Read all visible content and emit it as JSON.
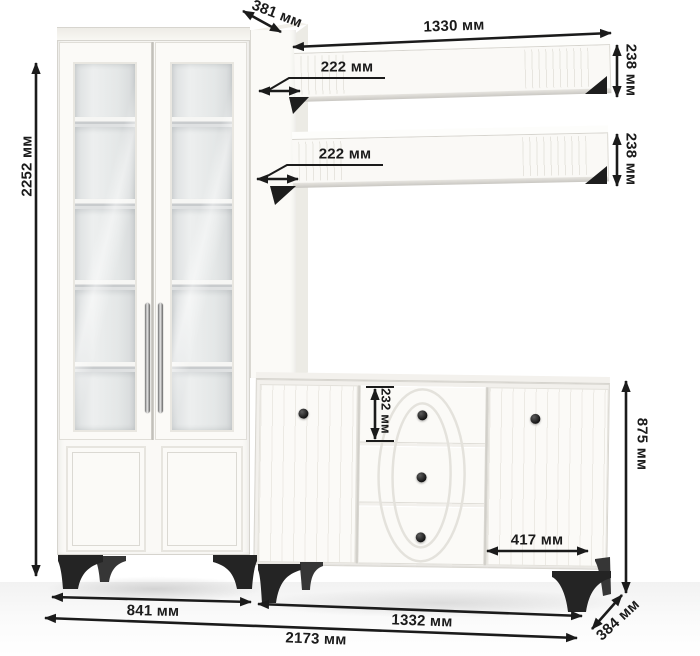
{
  "title": "furniture-dimensions-diagram",
  "units": "мм",
  "labels": {
    "total_height": "2252 мм",
    "column_depth": "381 мм",
    "shelf_width": "1330 мм",
    "shelf_depth_upper": "222 мм",
    "shelf_depth_lower": "222 мм",
    "shelf_height_upper": "238 мм",
    "shelf_height_lower": "238 мм",
    "drawer_height": "232 мм",
    "door_width": "417 мм",
    "sideboard_height": "875 мм",
    "cabinet_width": "841 мм",
    "sideboard_width": "1332 мм",
    "total_width": "2173 мм",
    "sideboard_depth": "384 мм"
  },
  "colors": {
    "background": "#ffffff",
    "furniture_white": "#faf9f6",
    "glass_interior": "#e6e8e9",
    "legs_and_knobs": "#242424",
    "dimension_ink": "#1b1b1b"
  }
}
